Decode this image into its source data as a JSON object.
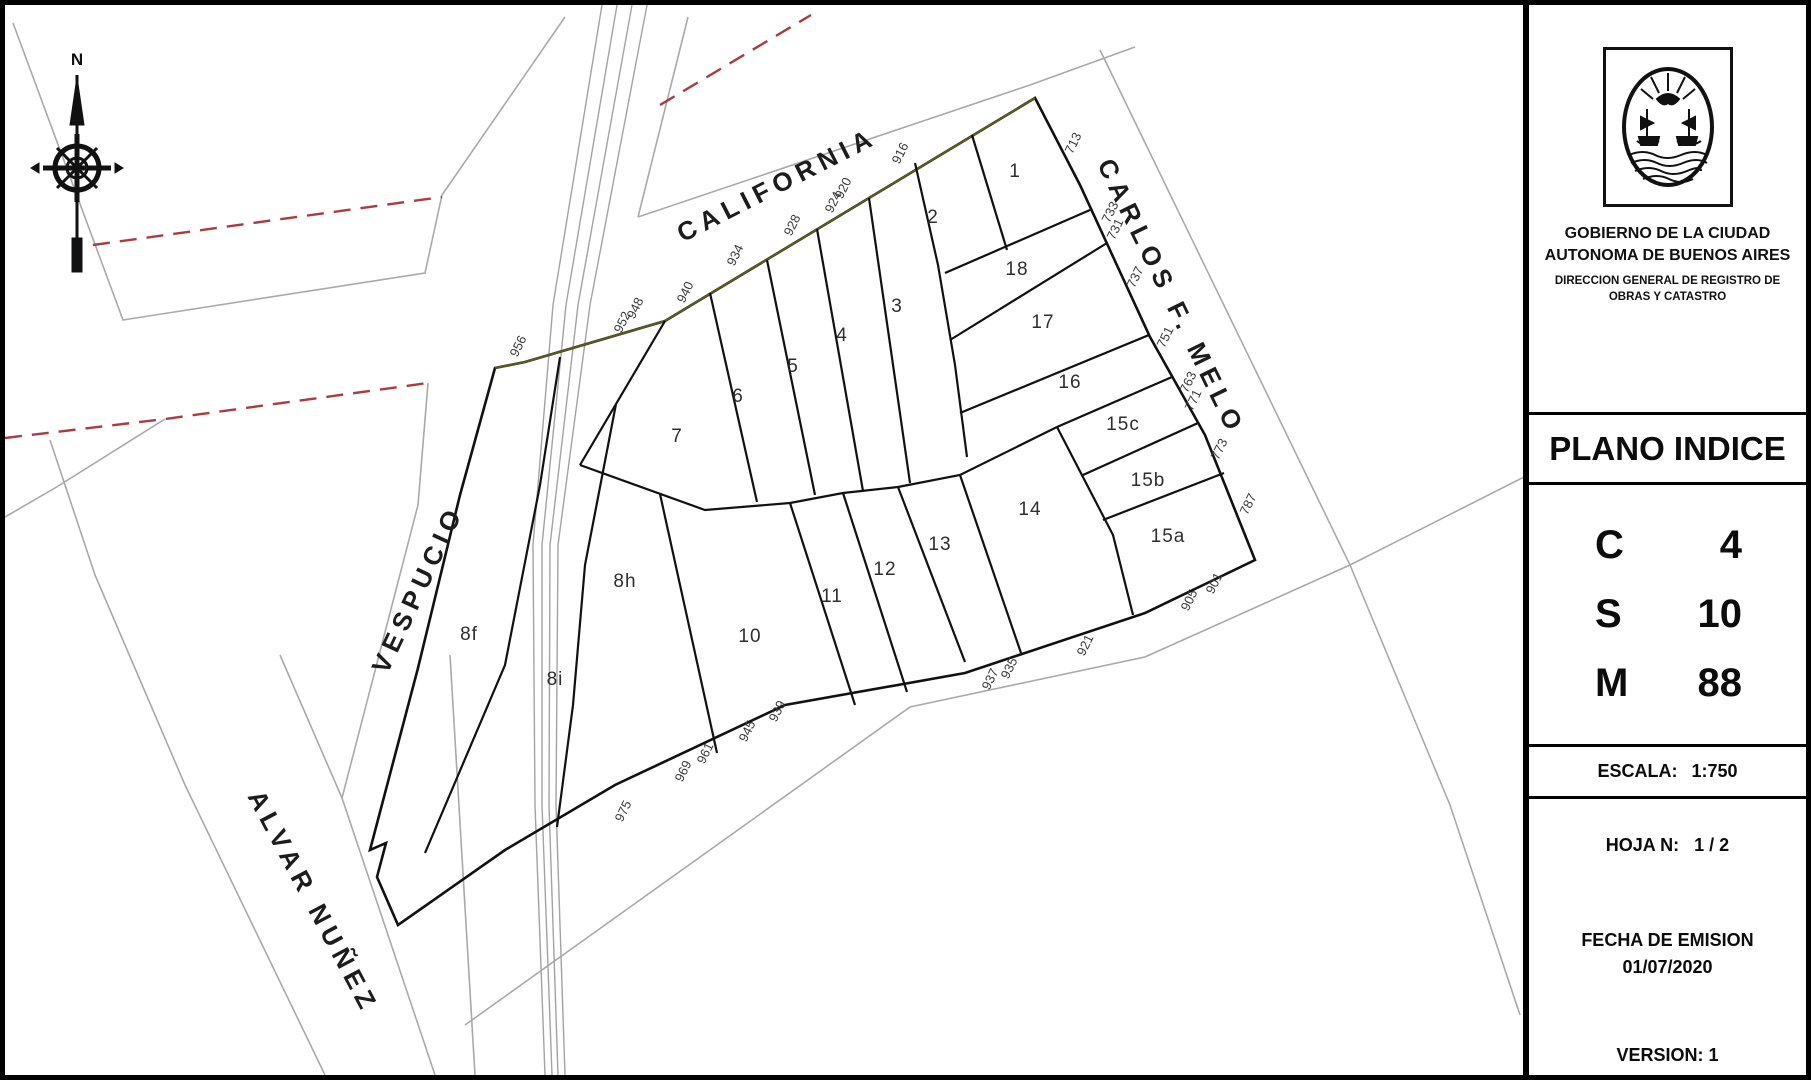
{
  "panel": {
    "org_line1": "GOBIERNO DE LA CIUDAD",
    "org_line2": "AUTONOMA DE BUENOS AIRES",
    "dir_line1": "DIRECCION GENERAL DE REGISTRO DE",
    "dir_line2": "OBRAS Y CATASTRO",
    "title": "PLANO INDICE",
    "csm": [
      {
        "key": "C",
        "value": "4"
      },
      {
        "key": "S",
        "value": "10"
      },
      {
        "key": "M",
        "value": "88"
      }
    ],
    "escala_label": "ESCALA:",
    "escala_value": "1:750",
    "hoja_label": "HOJA N:",
    "hoja_value": "1 / 2",
    "fecha_label": "FECHA DE EMISION",
    "fecha_value": "01/07/2020",
    "version_label": "VERSION:",
    "version_value": "1"
  },
  "map": {
    "compass_north": "N",
    "street_names": [
      {
        "label": "CALIFORNIA",
        "x": 772,
        "y": 180,
        "rot": -27
      },
      {
        "label": "CARLOS F. MELO",
        "x": 1166,
        "y": 292,
        "rot": 64
      },
      {
        "label": "VESPUCIO",
        "x": 413,
        "y": 584,
        "rot": -65
      },
      {
        "label": "ALVAR NUÑEZ",
        "x": 308,
        "y": 897,
        "rot": 62
      }
    ],
    "parcels": [
      {
        "label": "1",
        "x": 1010,
        "y": 167
      },
      {
        "label": "2",
        "x": 928,
        "y": 213
      },
      {
        "label": "3",
        "x": 892,
        "y": 302
      },
      {
        "label": "4",
        "x": 837,
        "y": 331
      },
      {
        "label": "5",
        "x": 788,
        "y": 362
      },
      {
        "label": "6",
        "x": 733,
        "y": 392
      },
      {
        "label": "7",
        "x": 672,
        "y": 432
      },
      {
        "label": "8h",
        "x": 620,
        "y": 577
      },
      {
        "label": "8f",
        "x": 464,
        "y": 630
      },
      {
        "label": "8i",
        "x": 550,
        "y": 675
      },
      {
        "label": "10",
        "x": 745,
        "y": 632
      },
      {
        "label": "11",
        "x": 827,
        "y": 592
      },
      {
        "label": "12",
        "x": 880,
        "y": 565
      },
      {
        "label": "13",
        "x": 935,
        "y": 540
      },
      {
        "label": "14",
        "x": 1025,
        "y": 505
      },
      {
        "label": "15a",
        "x": 1163,
        "y": 532
      },
      {
        "label": "15b",
        "x": 1143,
        "y": 476
      },
      {
        "label": "15c",
        "x": 1118,
        "y": 420
      },
      {
        "label": "16",
        "x": 1065,
        "y": 378
      },
      {
        "label": "17",
        "x": 1038,
        "y": 318
      },
      {
        "label": "18",
        "x": 1012,
        "y": 265
      }
    ],
    "addresses": [
      {
        "label": "916",
        "x": 895,
        "y": 148
      },
      {
        "label": "920",
        "x": 838,
        "y": 183
      },
      {
        "label": "924",
        "x": 828,
        "y": 197
      },
      {
        "label": "928",
        "x": 787,
        "y": 220
      },
      {
        "label": "934",
        "x": 730,
        "y": 250
      },
      {
        "label": "940",
        "x": 680,
        "y": 287
      },
      {
        "label": "948",
        "x": 630,
        "y": 303
      },
      {
        "label": "952",
        "x": 617,
        "y": 317
      },
      {
        "label": "956",
        "x": 513,
        "y": 341
      },
      {
        "label": "713",
        "x": 1068,
        "y": 138
      },
      {
        "label": "733",
        "x": 1105,
        "y": 207
      },
      {
        "label": "731",
        "x": 1110,
        "y": 224
      },
      {
        "label": "737",
        "x": 1130,
        "y": 272
      },
      {
        "label": "751",
        "x": 1160,
        "y": 332
      },
      {
        "label": "763",
        "x": 1183,
        "y": 377
      },
      {
        "label": "771",
        "x": 1188,
        "y": 395
      },
      {
        "label": "773",
        "x": 1214,
        "y": 444
      },
      {
        "label": "787",
        "x": 1243,
        "y": 499
      },
      {
        "label": "901",
        "x": 1209,
        "y": 578
      },
      {
        "label": "905",
        "x": 1184,
        "y": 595
      },
      {
        "label": "921",
        "x": 1080,
        "y": 640
      },
      {
        "label": "935",
        "x": 1004,
        "y": 663
      },
      {
        "label": "937",
        "x": 985,
        "y": 674
      },
      {
        "label": "939",
        "x": 772,
        "y": 706
      },
      {
        "label": "945",
        "x": 742,
        "y": 726
      },
      {
        "label": "961",
        "x": 700,
        "y": 748
      },
      {
        "label": "969",
        "x": 678,
        "y": 766
      },
      {
        "label": "975",
        "x": 618,
        "y": 806
      }
    ]
  }
}
